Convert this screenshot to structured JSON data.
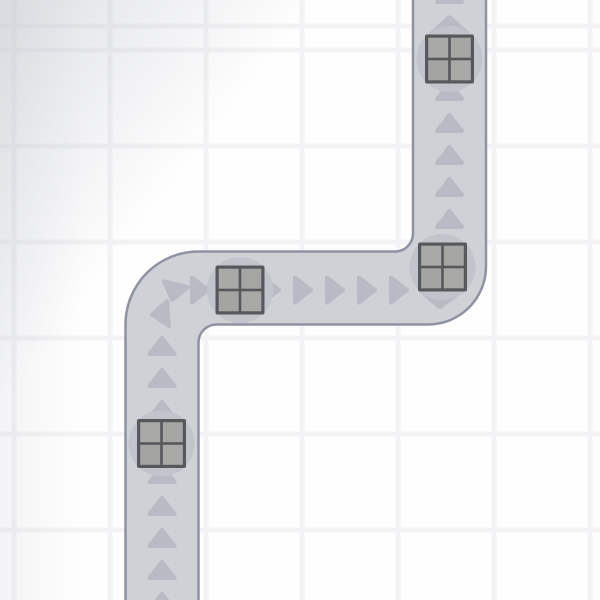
{
  "scene": {
    "description": "conveyor-belt path game board with crates moving up-right-up",
    "background": {
      "cell_color": "#fefefe",
      "grid_line_color": "#f3f3f5",
      "grid_line_width": 5,
      "grid_cell": 96,
      "grid_offset_x": 14,
      "grid_offset_y": 50,
      "vignette_color": "#ededef"
    },
    "belt": {
      "fill": "#cfd1d7",
      "border": "#8f93a0",
      "border_width": 2.5,
      "width": 73,
      "outline": "M 125.5 614 L 125.5 324.5 A 73 73 0 0 1 198.5 251.5 L 395 251.5 A 18 18 0 0 0 413 233.5 L 413 -14 L 486 -14 L 486 266.5 A 58 58 0 0 1 428 324.5 L 216.5 324.5 A 18 18 0 0 0 198.5 342.5 L 198.5 614 Z"
    },
    "arrow_style": {
      "icon": "triangle-direction-arrow",
      "color": "#b8bbc4",
      "width": 29,
      "height": 20
    },
    "arrows": [
      {
        "x": 162,
        "y": 602,
        "rot": 0
      },
      {
        "x": 162,
        "y": 570,
        "rot": 0
      },
      {
        "x": 162,
        "y": 538,
        "rot": 0
      },
      {
        "x": 162,
        "y": 506,
        "rot": 0
      },
      {
        "x": 162,
        "y": 474,
        "rot": 0
      },
      {
        "x": 162,
        "y": 410,
        "rot": 0
      },
      {
        "x": 162,
        "y": 378,
        "rot": 0
      },
      {
        "x": 162,
        "y": 346,
        "rot": 0
      },
      {
        "x": 160,
        "y": 314,
        "rot": 266
      },
      {
        "x": 174,
        "y": 292,
        "rot": 194
      },
      {
        "x": 200,
        "y": 290,
        "rot": 90
      },
      {
        "x": 271,
        "y": 290,
        "rot": 90
      },
      {
        "x": 303,
        "y": 290,
        "rot": 90
      },
      {
        "x": 335,
        "y": 290,
        "rot": 90
      },
      {
        "x": 367,
        "y": 290,
        "rot": 90
      },
      {
        "x": 399,
        "y": 290,
        "rot": 90
      },
      {
        "x": 440,
        "y": 300,
        "rot": 182,
        "sx": 1.4,
        "sy": 0.9
      },
      {
        "x": 449.5,
        "y": 219,
        "rot": 0
      },
      {
        "x": 449.5,
        "y": 187,
        "rot": 0
      },
      {
        "x": 449.5,
        "y": 155,
        "rot": 0
      },
      {
        "x": 449.5,
        "y": 123,
        "rot": 0
      },
      {
        "x": 449.5,
        "y": 91,
        "rot": 0
      },
      {
        "x": 449.5,
        "y": 25,
        "rot": 0,
        "sx": 1.35,
        "sy": 0.95
      },
      {
        "x": 449.5,
        "y": -6,
        "rot": 0
      }
    ],
    "pads": {
      "color": "#c2c4cb",
      "radius": 33,
      "items": [
        {
          "x": 449.5,
          "y": 59
        },
        {
          "x": 442.5,
          "y": 267
        },
        {
          "x": 240,
          "y": 290
        },
        {
          "x": 161.5,
          "y": 443.5
        }
      ]
    },
    "crates": {
      "size": 49,
      "border_color": "#56585c",
      "cell_colors": [
        "#a9a9a7",
        "#a5a5a4",
        "#a4a4a2",
        "#a8a8a6"
      ],
      "items": [
        {
          "x": 449.5,
          "y": 59
        },
        {
          "x": 442.5,
          "y": 267
        },
        {
          "x": 240,
          "y": 290
        },
        {
          "x": 161.5,
          "y": 443.5
        }
      ]
    }
  }
}
